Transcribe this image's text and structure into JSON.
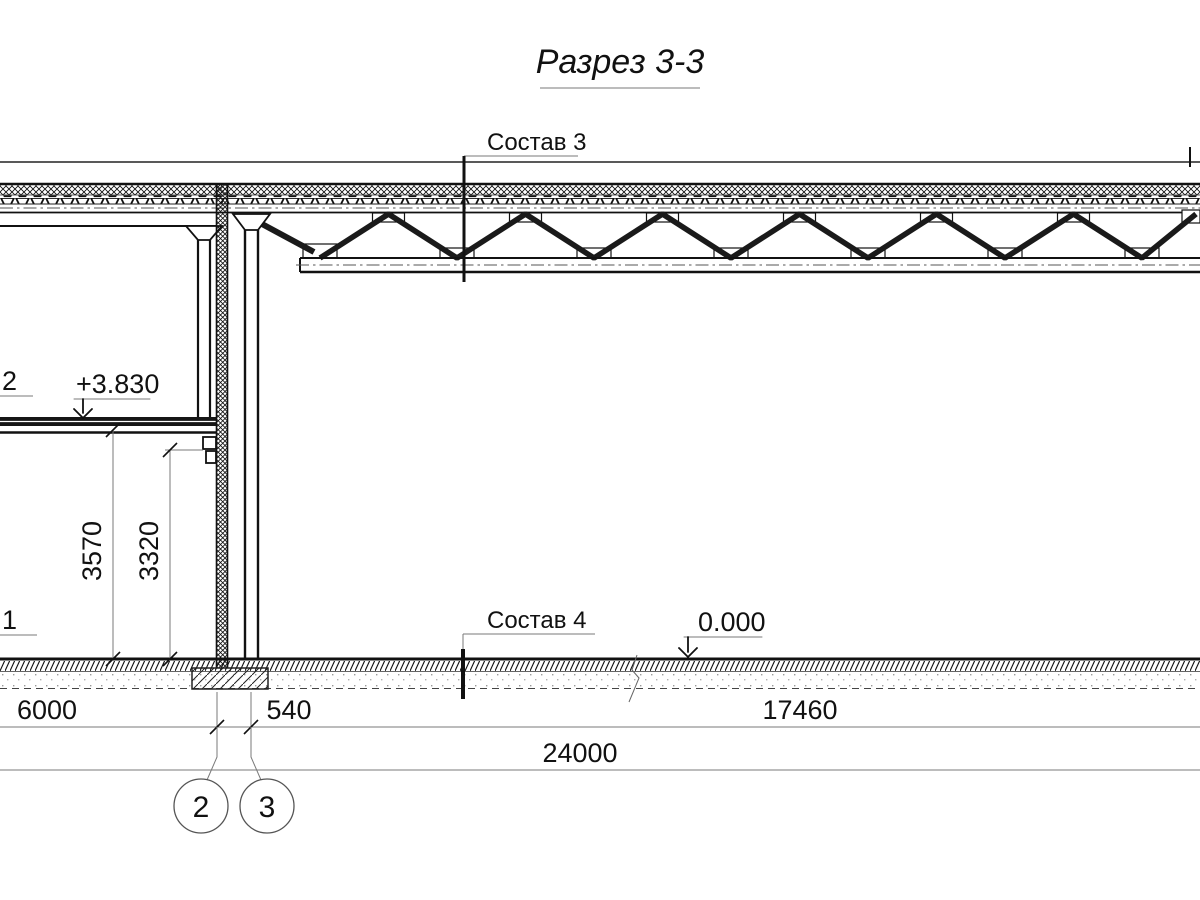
{
  "title": "Разрез 3-3",
  "labels": {
    "roof_section": "Состав 3",
    "floor_section": "Состав 4",
    "elevation_upper": "+3.830",
    "elevation_ground": "0.000",
    "callout_upper": "2",
    "callout_lower": "1"
  },
  "dimensions": {
    "span_left": "6000",
    "span_wall": "540",
    "span_hall": "17460",
    "total": "24000",
    "height_floor": "3570",
    "height_clear": "3320"
  },
  "grid_axes": {
    "left": "2",
    "right": "3"
  },
  "colors": {
    "line": "#161616",
    "dim_line": "#7a7a7a",
    "background": "#ffffff"
  }
}
